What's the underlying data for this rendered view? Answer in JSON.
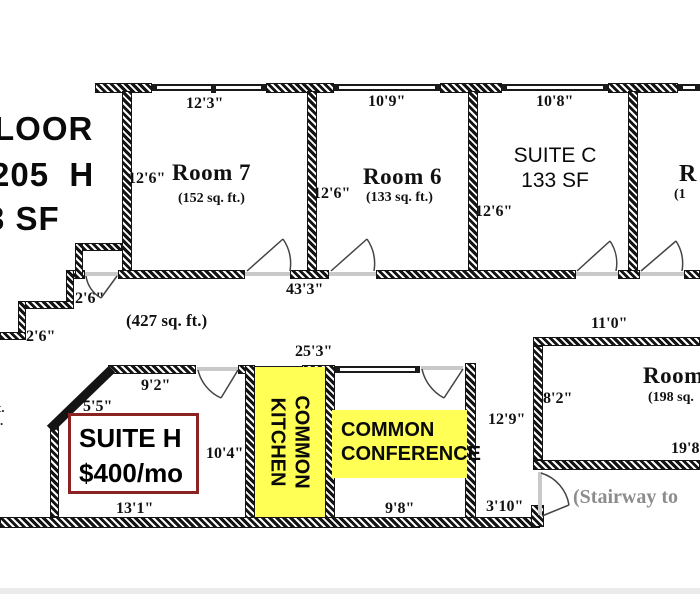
{
  "colors": {
    "wall": "#141414",
    "yellow": "#FFFF55",
    "suite_red": "#8B2323",
    "gray_text": "#8C8C8C"
  },
  "title": {
    "l1": "LOOR",
    "l2": "205  H",
    "l3": "3 SF"
  },
  "top_rooms": {
    "room7": {
      "name": "Room 7",
      "area": "(152 sq. ft.)",
      "top_dim": "12'3\"",
      "left_dim": "12'6\""
    },
    "room6": {
      "name": "Room 6",
      "area": "(133 sq. ft.)",
      "top_dim": "10'9\"",
      "left_dim": "12'6\""
    },
    "suite_c": {
      "name": "SUITE C",
      "area": "133 SF",
      "top_dim": "10'8\"",
      "left_dim": "12'6\""
    },
    "room_partial": {
      "name": "R",
      "area": "(1"
    }
  },
  "common_area": {
    "area": "(427 sq. ft.)",
    "bottom_dim": "43'3\"",
    "step_dim_a": "2'6\"",
    "step_dim_b": "2'6\"",
    "top_dim": "25'3\""
  },
  "suite_h": {
    "line1": "SUITE H",
    "line2": "$400/mo",
    "top_dim": "9'2\"",
    "corner_dim": "5'5\"",
    "right_dim": "10'4\"",
    "bottom_dim": "13'1\""
  },
  "kitchen": {
    "line1": "COMMON",
    "line2": "KITCHEN"
  },
  "conference": {
    "line1": "COMMON",
    "line2": "CONFERENCE",
    "bottom_dim": "9'8\"",
    "right_dim": "12'9\""
  },
  "passage": {
    "dim": "3'10\""
  },
  "room8": {
    "name": "Room",
    "area": "(198 sq.",
    "top_dim": "11'0\"",
    "left_dim": "8'2\"",
    "bottom_dim": "19'8"
  },
  "stairway_note": "(Stairway to",
  "fragments": {
    "f1": "t.",
    "f2": "."
  }
}
